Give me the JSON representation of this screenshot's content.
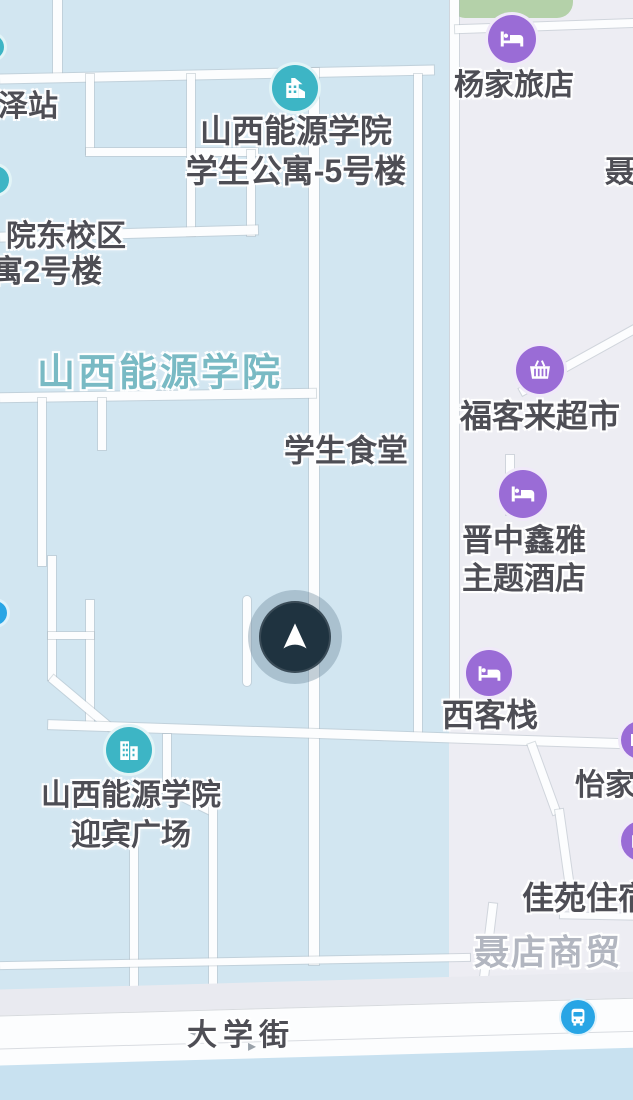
{
  "map_view": {
    "type": "street-map",
    "areas": {
      "campus_label": "山西能源学院",
      "commercial_label": "聂店商贸"
    },
    "pois": {
      "yangjia": {
        "label": "杨家旅店",
        "icon": "hotel-bed-icon"
      },
      "dorm5": {
        "line1": "山西能源学院",
        "line2": "学生公寓-5号楼",
        "icon": "school-building-icon"
      },
      "zezhan": {
        "label": "泽站"
      },
      "east_campus": {
        "line1": "院东校区",
        "line2": "寓2号楼"
      },
      "canteen": {
        "label": "学生食堂"
      },
      "fukelai": {
        "label": "福客来超市",
        "icon": "supermarket-basket-icon"
      },
      "xinya": {
        "line1": "晋中鑫雅",
        "line2": "主题酒店",
        "icon": "hotel-bed-icon"
      },
      "xikezhan": {
        "label": "西客栈",
        "icon": "hotel-bed-icon"
      },
      "yijia": {
        "label": "怡家",
        "icon": "hotel-bed-icon"
      },
      "jiayuan": {
        "label": "佳苑住宿",
        "icon": "hotel-bed-icon"
      },
      "yingbin": {
        "line1": "山西能源学院",
        "line2": "迎宾广场",
        "icon": "civic-building-icon"
      },
      "nie_partial": {
        "label": "聂"
      },
      "bus_stop": {
        "icon": "bus-icon"
      }
    },
    "street": {
      "daxue": {
        "label": "大学街",
        "arrow_left": "◂",
        "arrow_right": "▸"
      }
    },
    "marker": {
      "type": "current-location-arrow"
    },
    "colors": {
      "campus_fill": "#d2e6f1",
      "commercial_fill": "#ededf3",
      "water_bottom_fill": "#c8e1f0",
      "road_fill": "#fcfdfe",
      "park_green": "#b4d1a9",
      "poi_purple": "#9a6cd6",
      "poi_teal": "#3db5c5",
      "poi_blue": "#28a5e5",
      "campus_text": "#79bac4",
      "label_text": "#4e4e55",
      "faded_text": "#b2b6c0",
      "marker_navy": "#1f3340"
    }
  }
}
